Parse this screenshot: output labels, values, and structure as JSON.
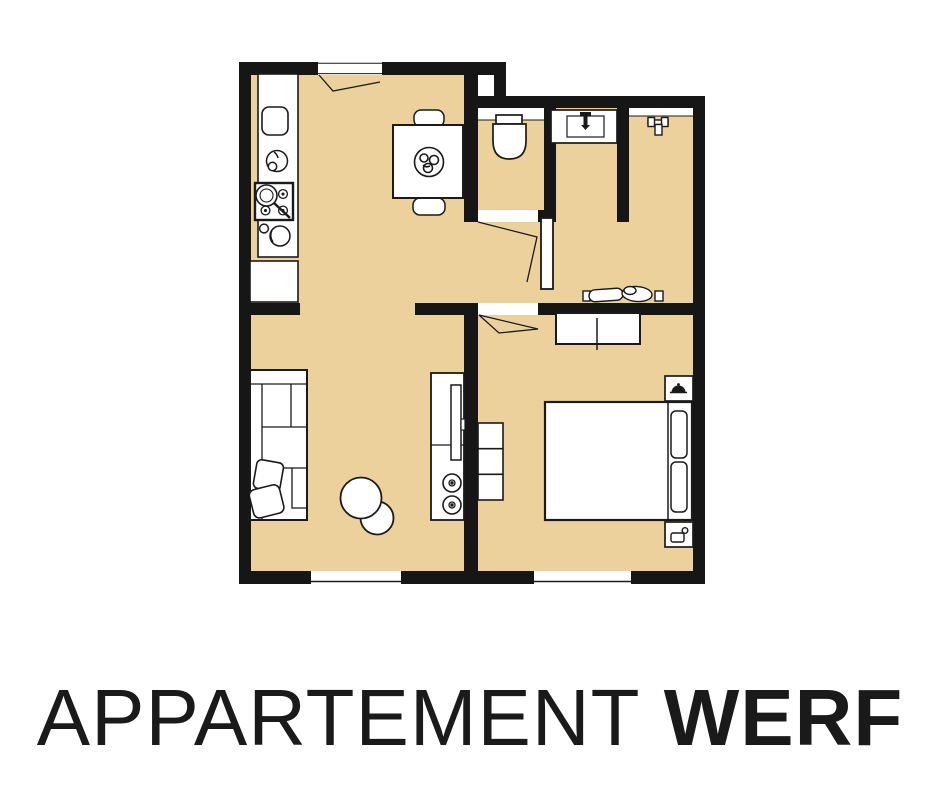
{
  "title": {
    "light": "APPARTEMENT",
    "separator": " ",
    "bold": "WERF"
  },
  "colors": {
    "floor": "#ecd19c",
    "wall": "#161616",
    "line": "#1a1a1a",
    "background": "#ffffff"
  },
  "floor_plan": {
    "rooms": [
      "kitchen-dining",
      "wc",
      "bathroom",
      "shower",
      "hallway",
      "living-room",
      "bedroom"
    ],
    "furniture_icons": [
      "fridge-icon",
      "kitchen-sink-icon",
      "stove-icon",
      "pot-icon",
      "dining-table-icon",
      "chair-icon",
      "plant-centerpiece-icon",
      "toilet-icon",
      "washbasin-icon",
      "faucet-icon",
      "shower-fixture-icon",
      "clothes-rack-icon",
      "sideboard-icon",
      "bed-icon",
      "pillow-icon",
      "lamp-icon",
      "carafe-icon",
      "drawer-unit-icon",
      "sofa-icon",
      "cushion-icon",
      "pouf-icon",
      "tv-cabinet-icon",
      "speaker-icon",
      "door-leaf-icon",
      "door-swing-icon",
      "window-icon"
    ]
  }
}
